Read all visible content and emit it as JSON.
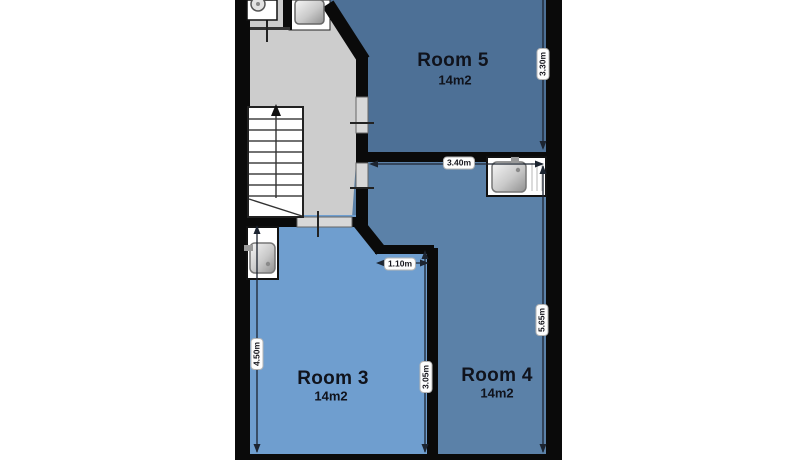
{
  "plan": {
    "type": "floor-plan",
    "rooms": [
      {
        "name": "Room 5",
        "area": "14m2",
        "color": "#4d7096"
      },
      {
        "name": "Room 3",
        "area": "14m2",
        "color": "#6f9ecf"
      },
      {
        "name": "Room 4",
        "area": "14m2",
        "color": "#5b81a8"
      }
    ],
    "dimensions": {
      "room5_height": "3.30m",
      "room4_width": "3.40m",
      "room4_height": "5.65m",
      "room3_height": "4.50m",
      "room3_notch_width": "1.10m",
      "room3_inner_height": "3.05m"
    },
    "fixtures": [
      {
        "name": "staircase",
        "location": "hallway"
      },
      {
        "name": "toilet",
        "location": "hallway-top"
      },
      {
        "name": "sink",
        "location": "room5-alcove"
      },
      {
        "name": "sink",
        "location": "room4-top-right"
      },
      {
        "name": "sink",
        "location": "room3-top-left"
      }
    ],
    "colors": {
      "wall": "#0a0a0a",
      "hallway": "#cdcdcd",
      "room3": "#6f9ecf",
      "room4": "#5b81a8",
      "room5": "#4d7096",
      "dimension_line": "#1c2430"
    }
  }
}
